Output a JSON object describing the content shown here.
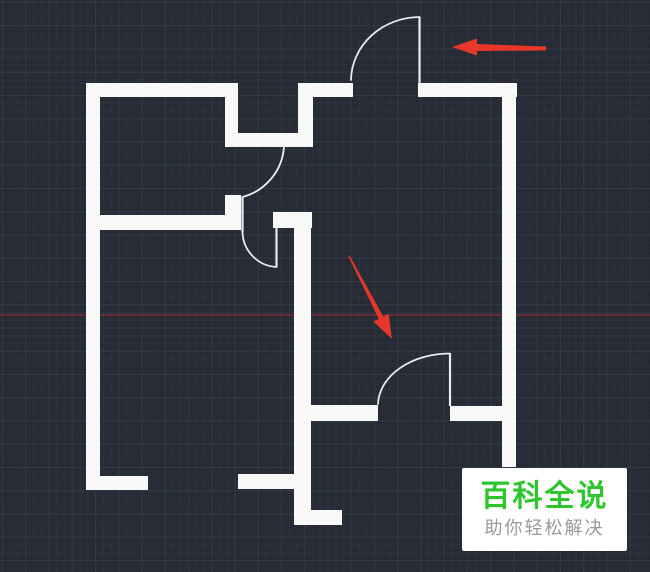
{
  "app": {
    "view_label": "cad-floor-plan-viewport"
  },
  "canvas": {
    "width": 650,
    "height": 572,
    "background": "#262B34",
    "grid_major_color": "#313948",
    "grid_minor_color": "#2B3140",
    "grid_major_size": 23.25,
    "grid_minor_size": 7.75
  },
  "axis_line": {
    "y": 315,
    "color": "rgba(190,44,58,0.55)",
    "width": 1.5
  },
  "floor_plan": {
    "wall_color": "#F8F8F6",
    "line_color": "#E9EBEE",
    "leaf_width": 2.2,
    "arc_width": 1.8,
    "walls": [
      {
        "name": "left-wall",
        "x": 86,
        "y": 83,
        "w": 14,
        "h": 407
      },
      {
        "name": "top-wall-a",
        "x": 86,
        "y": 83,
        "w": 152,
        "h": 14
      },
      {
        "name": "alcove-left-leg",
        "x": 225,
        "y": 83,
        "w": 13,
        "h": 64
      },
      {
        "name": "alcove-bottom-bar",
        "x": 225,
        "y": 133,
        "w": 88,
        "h": 14
      },
      {
        "name": "alcove-right-leg",
        "x": 298,
        "y": 83,
        "w": 15,
        "h": 64
      },
      {
        "name": "top-wall-b",
        "x": 298,
        "y": 83,
        "w": 55,
        "h": 14
      },
      {
        "name": "top-wall-c",
        "x": 418,
        "y": 83,
        "w": 99,
        "h": 14
      },
      {
        "name": "right-wall",
        "x": 502,
        "y": 83,
        "w": 14,
        "h": 384
      },
      {
        "name": "interior-wall-left",
        "x": 90,
        "y": 215,
        "w": 151,
        "h": 15
      },
      {
        "name": "interior-door-jamb",
        "x": 225,
        "y": 195,
        "w": 16,
        "h": 35
      },
      {
        "name": "central-wall-head",
        "x": 273,
        "y": 212,
        "w": 39,
        "h": 16
      },
      {
        "name": "central-wall",
        "x": 294,
        "y": 212,
        "w": 17,
        "h": 313
      },
      {
        "name": "lower-wall-left",
        "x": 311,
        "y": 405,
        "w": 67,
        "h": 16
      },
      {
        "name": "lower-wall-right",
        "x": 450,
        "y": 406,
        "w": 52,
        "h": 15
      },
      {
        "name": "bottom-wall-a",
        "x": 86,
        "y": 476,
        "w": 62,
        "h": 14
      },
      {
        "name": "bottom-wall-b",
        "x": 238,
        "y": 474,
        "w": 57,
        "h": 15
      },
      {
        "name": "bottom-step-bar",
        "x": 311,
        "y": 510,
        "w": 31,
        "h": 15
      }
    ],
    "door_leaves": [
      {
        "name": "top-door-leaf",
        "x1": 419.5,
        "y1": 17,
        "x2": 419.5,
        "y2": 83
      },
      {
        "name": "door-a-leaf",
        "x1": 242.5,
        "y1": 197,
        "x2": 242.5,
        "y2": 232
      },
      {
        "name": "door-b-leaf",
        "x1": 276.5,
        "y1": 228,
        "x2": 276.5,
        "y2": 267
      },
      {
        "name": "bottom-door-leaf",
        "x1": 450,
        "y1": 353,
        "x2": 450,
        "y2": 406
      }
    ],
    "door_arcs": [
      {
        "name": "top-door-arc",
        "d": "M 419.5 17 A 69 64 0 0 0 351 80"
      },
      {
        "name": "door-a-arc",
        "d": "M 284 147 A 56 56 0 0 1 242.5 197"
      },
      {
        "name": "door-b-arc",
        "d": "M 242.5 232 A 36 36 0 0 0 276.5 267"
      },
      {
        "name": "bottom-door-arc",
        "d": "M 378 404 A 72 52 0 0 1 450 353.5"
      }
    ]
  },
  "annotations": {
    "arrow_color": "#E8362B",
    "arrows": [
      {
        "name": "arrow-pointing-left-at-top-door",
        "points": "452,47 477,38.5 477,44 546,46.5 546,50.5 477,51 477,55.5"
      },
      {
        "name": "arrow-pointing-down-right-at-bottom-door",
        "points": "392,339 388.6,313.8 383.2,316.6 349.7,255.7 348.3,256.3 378.8,318.9 373.4,321.6"
      }
    ]
  },
  "watermark": {
    "title": "百科全说",
    "subtitle": "助你轻松解决",
    "title_color": "#2EC52E",
    "subtitle_color": "#9A9A9A",
    "box": {
      "x": 462,
      "y": 468,
      "w": 165,
      "h": 83
    }
  }
}
